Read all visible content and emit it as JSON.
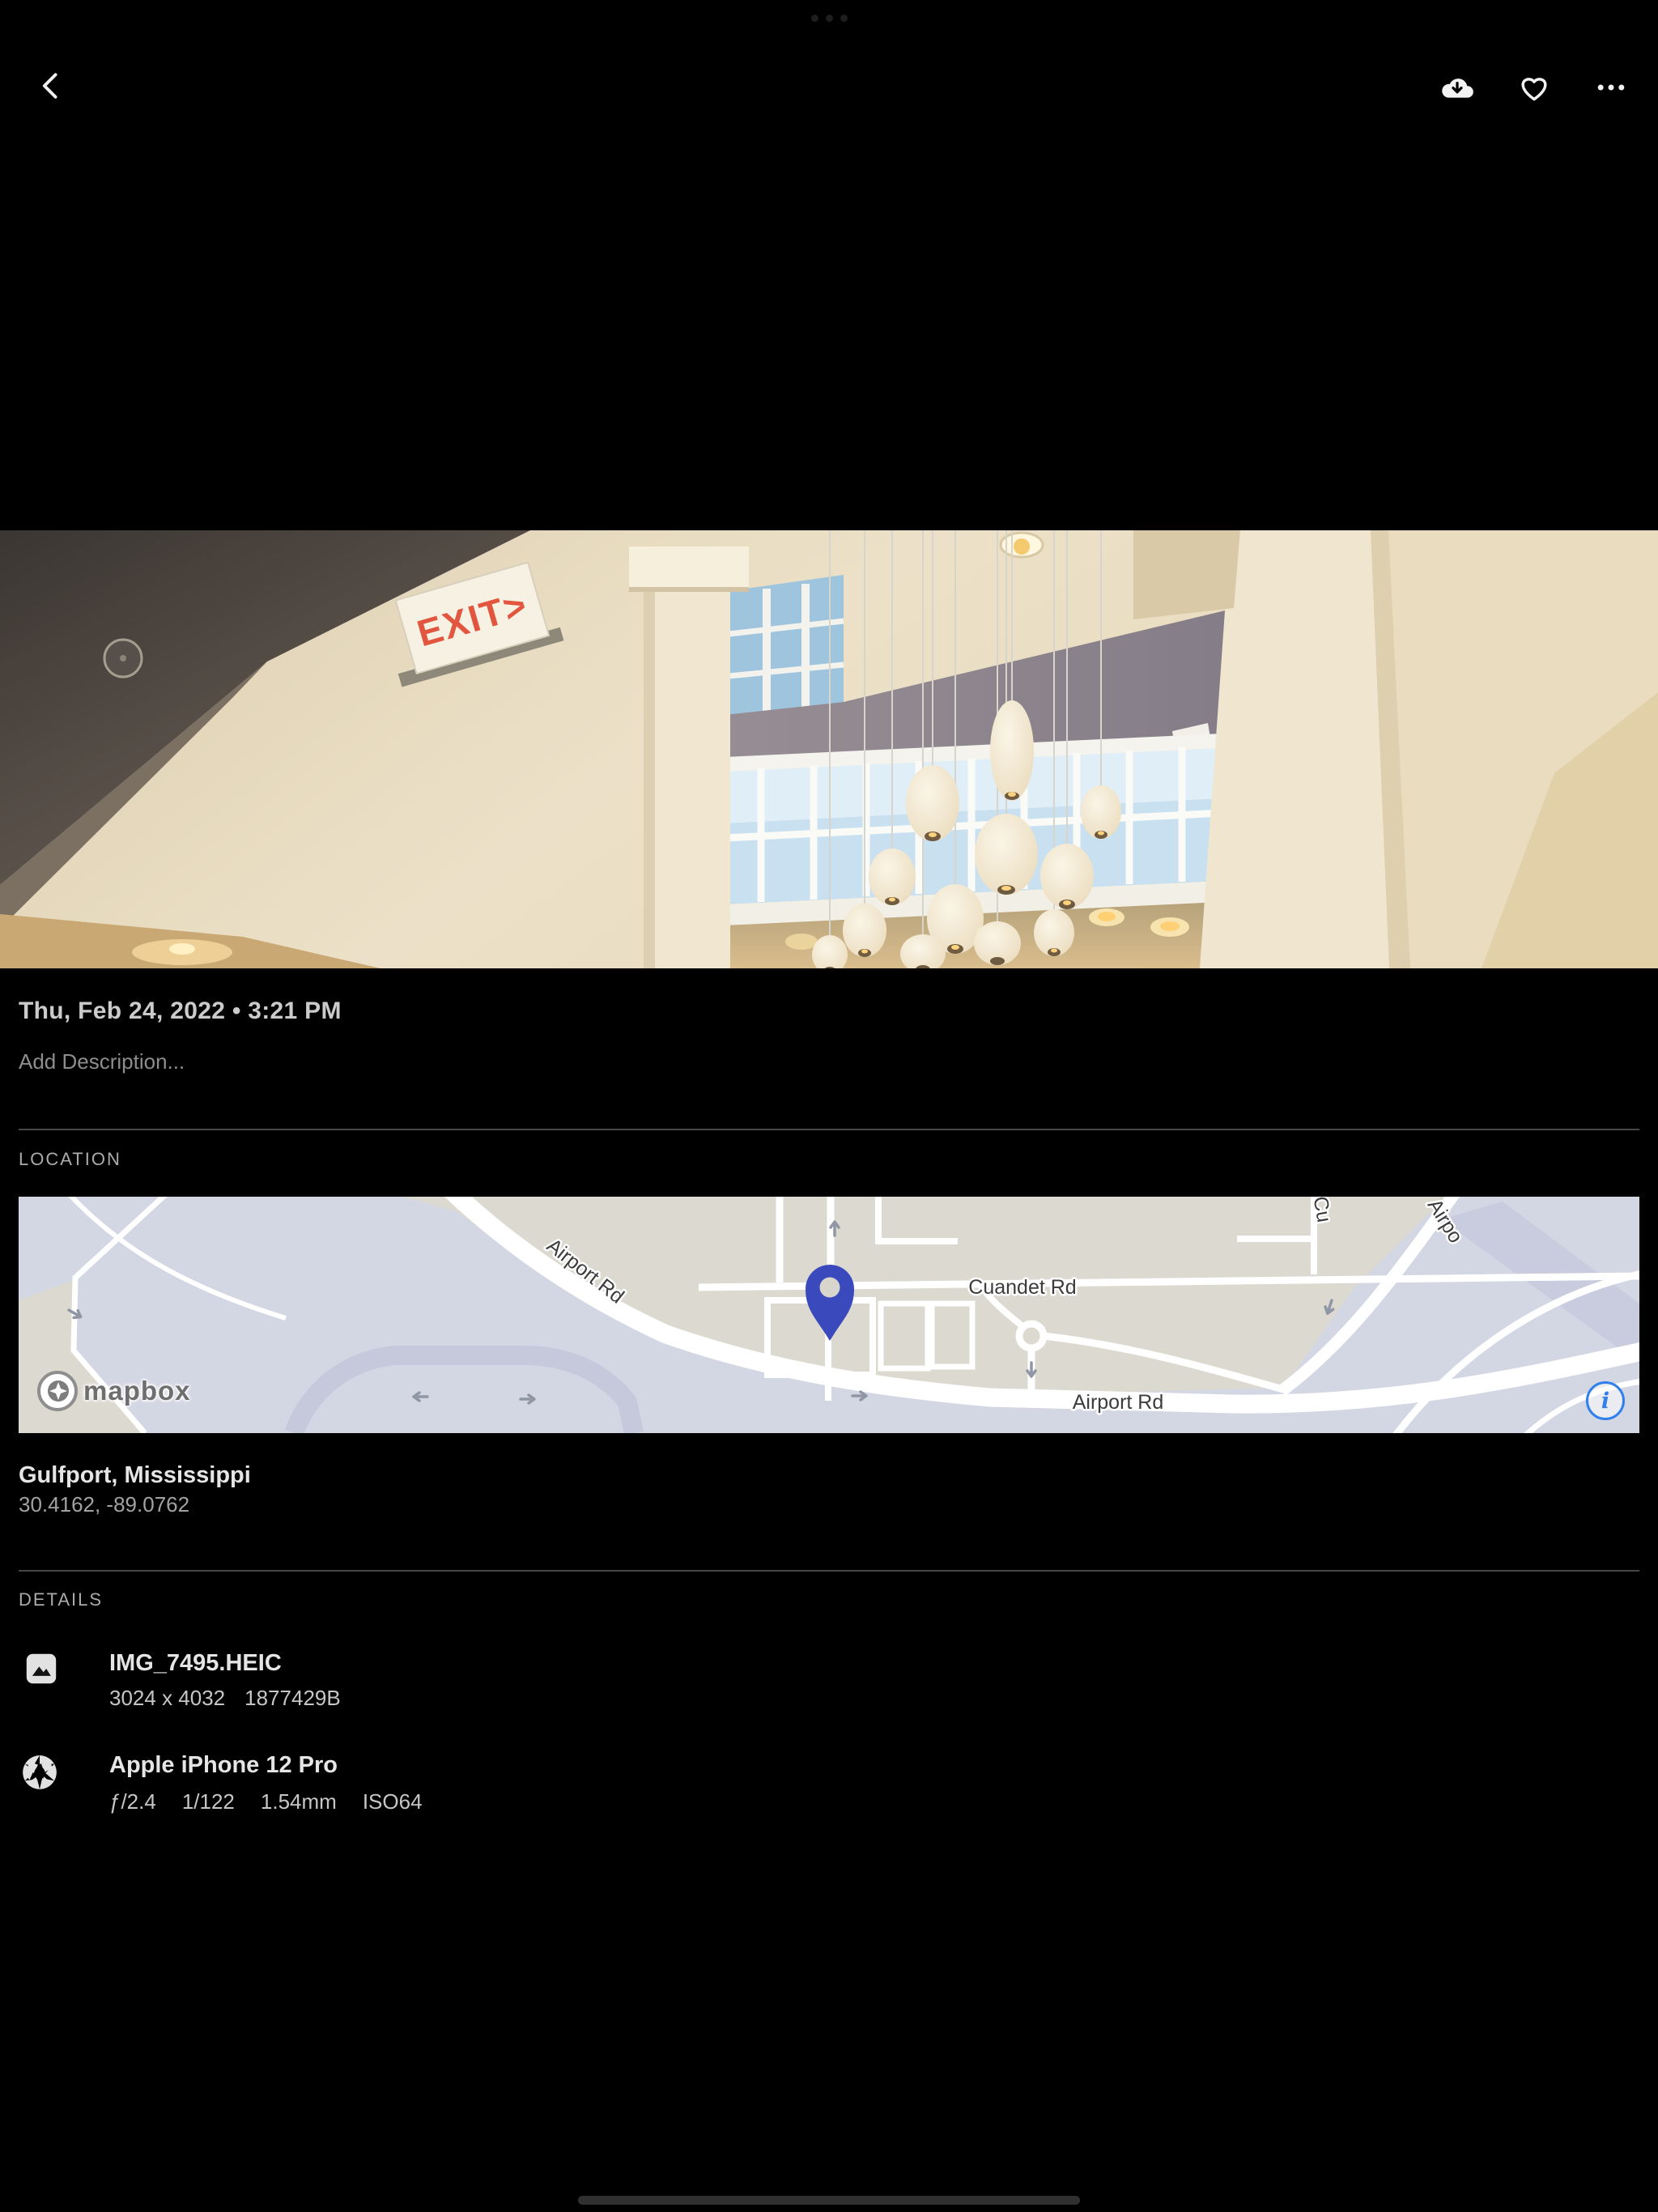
{
  "system": {
    "multitask_icon": "three-dots-indicator",
    "home_indicator_icon": "home-bar"
  },
  "toolbar": {
    "back_icon": "chevron-left",
    "download_icon": "cloud-download",
    "favorite_icon": "heart-outline",
    "more_icon": "ellipsis-horizontal"
  },
  "photo": {
    "exit_sign": "EXIT>"
  },
  "meta": {
    "datetime": "Thu, Feb 24, 2022 • 3:21 PM",
    "description_placeholder": "Add Description..."
  },
  "location": {
    "label": "LOCATION",
    "place": "Gulfport, Mississippi",
    "coordinates": "30.4162, -89.0762",
    "map": {
      "road_airport_diagonal": "Airport Rd",
      "road_cuandet": "Cuandet Rd",
      "road_airport_horizontal": "Airport Rd",
      "road_airport_partial": "Airpo",
      "road_c_partial": "Cu",
      "logo_text": "mapbox",
      "info_glyph": "i",
      "pin_color": "#3a4abd",
      "land_color": "#dcd9d1",
      "area_color": "#d3d6e3",
      "info_blue": "#2f80ec"
    }
  },
  "details": {
    "label": "DETAILS",
    "file": {
      "name": "IMG_7495.HEIC",
      "dimensions": "3024 x 4032",
      "size": "1877429B"
    },
    "camera": {
      "name": "Apple iPhone 12 Pro",
      "aperture": "ƒ/2.4",
      "shutter": "1/122",
      "focal_length": "1.54mm",
      "iso": "ISO64"
    }
  }
}
